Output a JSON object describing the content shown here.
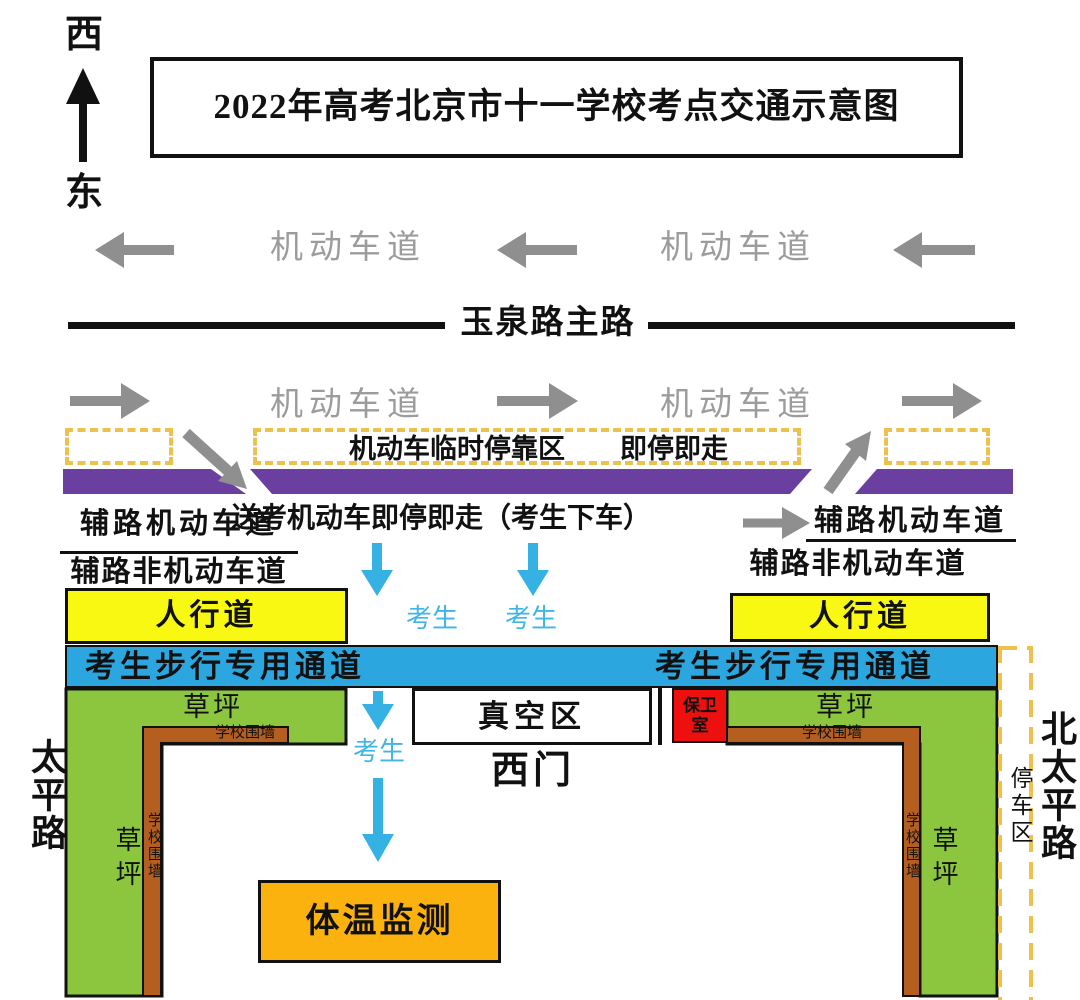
{
  "compass": {
    "west": "西",
    "east": "东"
  },
  "title": "2022年高考北京市十一学校考点交通示意图",
  "main_road": {
    "name": "玉泉路主路",
    "motor_lane": "机动车道"
  },
  "drop_zone": {
    "temp_stop": "机动车临时停靠区",
    "stop_go": "即停即走",
    "drop_note": "送考机动车即停即走（考生下车）"
  },
  "service_road": {
    "motor": "辅路机动车道",
    "non_motor": "辅路非机动车道"
  },
  "pedestrian": {
    "student": "考生",
    "sidewalk": "人行道",
    "corridor": "考生步行专用通道"
  },
  "campus": {
    "lawn": "草坪",
    "wall": "学校围墙",
    "vacuum": "真空区",
    "gate": "西门",
    "guard_line1": "保卫",
    "guard_line2": "室",
    "temp_check": "体温监测"
  },
  "streets": {
    "left": "太平路",
    "right": "北太平路",
    "parking": "停车区"
  },
  "colors": {
    "purple_ramp": "#6a3fa0",
    "gold_dash": "#eec04e",
    "cyan_arrow": "#35b1e4",
    "blue_corridor": "#2ba6df",
    "yellow_sidewalk": "#f8f812",
    "green_lawn": "#8cc63e",
    "brown_wall": "#b45f1f",
    "red_guard": "#ee0f0f",
    "orange_temp": "#fbb10e",
    "gray_arrow": "#8f8f8f",
    "black": "#111111"
  }
}
